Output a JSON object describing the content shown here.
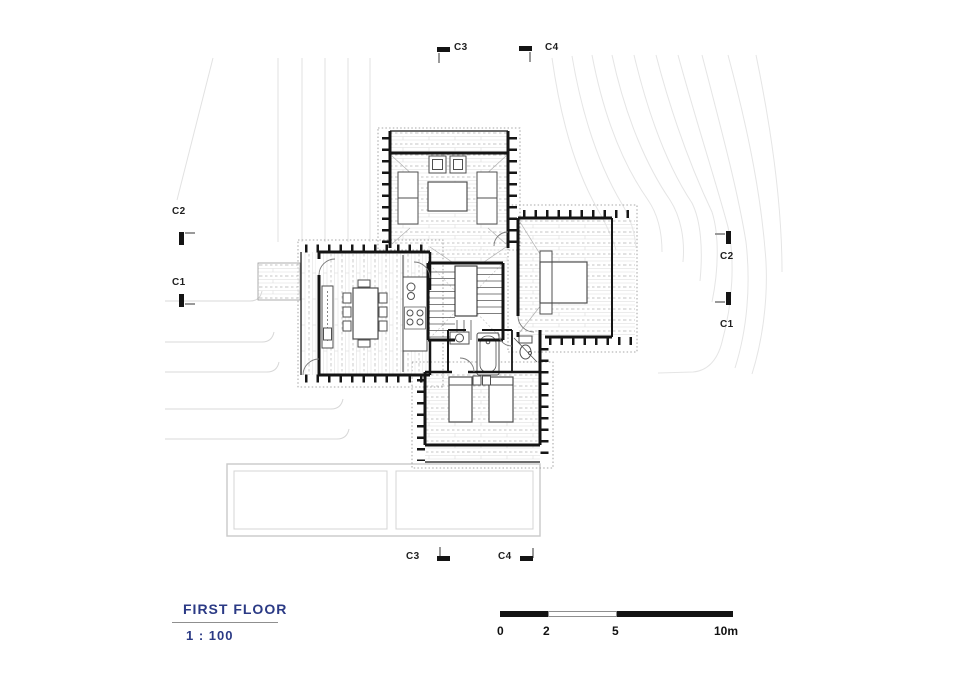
{
  "title_block": {
    "title": "FIRST FLOOR",
    "scale": "1 : 100"
  },
  "markers": {
    "c2_left": "C2",
    "c1_left": "C1",
    "c2_right": "C2",
    "c1_right": "C1",
    "c3_top": "C3",
    "c4_top": "C4",
    "c3_bottom": "C3",
    "c4_bottom": "C4"
  },
  "scale_bar": {
    "t0": "0",
    "t2": "2",
    "t5": "5",
    "t10": "10m"
  },
  "colors": {
    "title_text": "#2b3a85",
    "ink": "#141414",
    "contour": "#e5e5e5",
    "pool_outline": "#c9c9c9"
  }
}
